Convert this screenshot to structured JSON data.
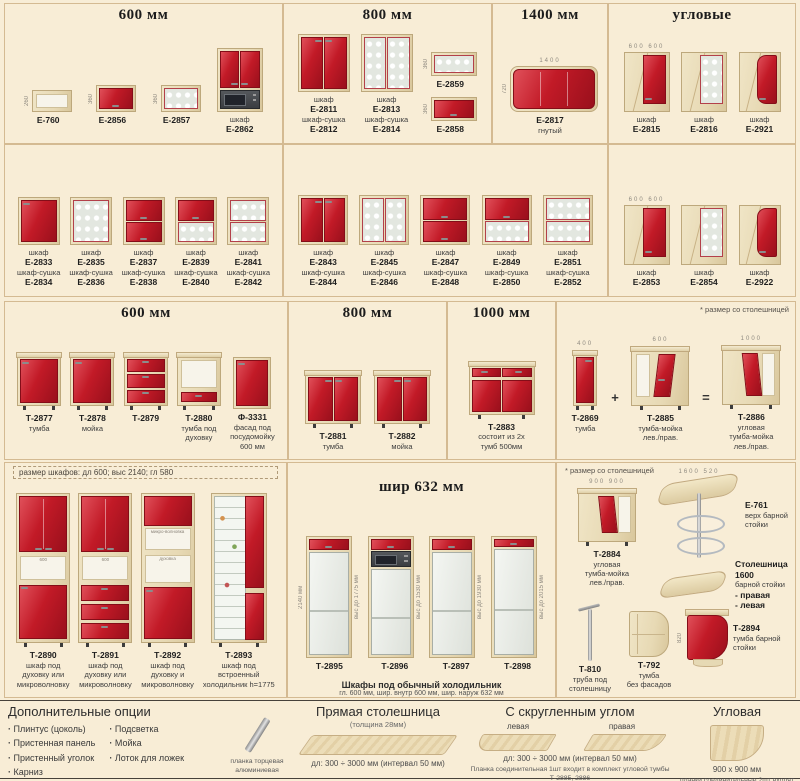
{
  "page": {
    "bg": "#f8edd6",
    "accent_red": "#c21a27",
    "wood": "#e7d9b4"
  },
  "sections": {
    "wall600": {
      "title": "600 мм",
      "items": [
        {
          "style": "openbox",
          "w": 40,
          "h": 22,
          "vl": "260",
          "label": [
            "Е-760"
          ]
        },
        {
          "style": "flip-red",
          "w": 40,
          "h": 27,
          "vl": "360",
          "label": [
            "Е-2856"
          ]
        },
        {
          "style": "flip-glass",
          "w": 40,
          "h": 27,
          "vl": "360",
          "label": [
            "Е-2857"
          ]
        },
        {
          "style": "wall-micro",
          "w": 46,
          "h": 64,
          "label": [
            "шкаф",
            "Е-2862"
          ]
        }
      ]
    },
    "wall800": {
      "title": "800 мм",
      "items": [
        {
          "style": "doors2-red",
          "w": 52,
          "h": 58,
          "label": [
            "шкаф",
            "Е-2811",
            "шкаф-сушка",
            "Е-2812"
          ]
        },
        {
          "style": "doors2-glass",
          "w": 52,
          "h": 58,
          "label": [
            "шкаф",
            "Е-2813",
            "шкаф-сушка",
            "Е-2814"
          ]
        },
        {
          "style": "flip-glass",
          "w": 46,
          "h": 24,
          "vl": "360",
          "label": [
            "Е-2859"
          ]
        },
        {
          "style": "flip-red",
          "w": 46,
          "h": 24,
          "vl": "360",
          "label": [
            "Е-2858"
          ]
        }
      ]
    },
    "wall1400": {
      "title": "1400 мм",
      "items": [
        {
          "style": "bent",
          "w": 88,
          "h": 46,
          "dims": [
            "1400"
          ],
          "vl": "720",
          "label": [
            "Е-2817",
            "гнутый"
          ]
        }
      ]
    },
    "wallcorner": {
      "title": "угловые",
      "items": [
        {
          "style": "corner-red",
          "w": 46,
          "h": 60,
          "dims": [
            "600",
            "600"
          ],
          "label": [
            "шкаф",
            "Е-2815"
          ]
        },
        {
          "style": "corner-glass",
          "w": 46,
          "h": 60,
          "label": [
            "шкаф",
            "Е-2816"
          ]
        },
        {
          "style": "corner-radius",
          "w": 42,
          "h": 60,
          "label": [
            "шкаф",
            "Е-2921"
          ]
        }
      ]
    },
    "row2a": {
      "items": [
        {
          "style": "door1-red",
          "w": 42,
          "h": 48,
          "label": [
            "шкаф",
            "Е-2833",
            "шкаф-сушка",
            "Е-2834"
          ]
        },
        {
          "style": "door1-glass",
          "w": 42,
          "h": 48,
          "label": [
            "шкаф",
            "Е-2835",
            "шкаф-сушка",
            "Е-2836"
          ]
        },
        {
          "style": "flip2-red",
          "w": 42,
          "h": 48,
          "label": [
            "шкаф",
            "Е-2837",
            "шкаф-сушка",
            "Е-2838"
          ]
        },
        {
          "style": "flip-red-glass",
          "w": 42,
          "h": 48,
          "label": [
            "шкаф",
            "Е-2839",
            "шкаф-сушка",
            "Е-2840"
          ]
        },
        {
          "style": "flip2-glass",
          "w": 42,
          "h": 48,
          "label": [
            "шкаф",
            "Е-2841",
            "шкаф-сушка",
            "Е-2842"
          ]
        }
      ]
    },
    "row2b": {
      "items": [
        {
          "style": "doors2-red",
          "w": 50,
          "h": 50,
          "label": [
            "шкаф",
            "Е-2843",
            "шкаф-сушка",
            "Е-2844"
          ]
        },
        {
          "style": "doors2-glass",
          "w": 50,
          "h": 50,
          "label": [
            "шкаф",
            "Е-2845",
            "шкаф-сушка",
            "Е-2846"
          ]
        },
        {
          "style": "flip2-red",
          "w": 50,
          "h": 50,
          "label": [
            "шкаф",
            "Е-2847",
            "шкаф-сушка",
            "Е-2848"
          ]
        },
        {
          "style": "flip-red-glass",
          "w": 50,
          "h": 50,
          "label": [
            "шкаф",
            "Е-2849",
            "шкаф-сушка",
            "Е-2850"
          ]
        },
        {
          "style": "flip2-glass",
          "w": 50,
          "h": 50,
          "label": [
            "шкаф",
            "Е-2851",
            "шкаф-сушка",
            "Е-2852"
          ]
        }
      ]
    },
    "row2c": {
      "items": [
        {
          "style": "corner-red",
          "w": 46,
          "h": 60,
          "dims": [
            "600",
            "600"
          ],
          "label": [
            "шкаф",
            "Е-2853"
          ]
        },
        {
          "style": "corner-glass",
          "w": 46,
          "h": 60,
          "label": [
            "шкаф",
            "Е-2854"
          ]
        },
        {
          "style": "corner-radius",
          "w": 42,
          "h": 60,
          "label": [
            "шкаф",
            "Е-2922"
          ]
        }
      ]
    },
    "base600": {
      "title": "600 мм",
      "items": [
        {
          "style": "base-door1",
          "w": 44,
          "h": 50,
          "base": true,
          "legs": true,
          "label": [
            "Т-2877",
            "тумба"
          ]
        },
        {
          "style": "base-door1",
          "w": 44,
          "h": 50,
          "base": true,
          "legs": true,
          "label": [
            "Т-2878",
            "мойка"
          ]
        },
        {
          "style": "base-drawers3",
          "w": 44,
          "h": 50,
          "base": true,
          "legs": true,
          "label": [
            "Т-2879"
          ]
        },
        {
          "style": "base-oven",
          "w": 44,
          "h": 50,
          "base": true,
          "legs": true,
          "label": [
            "Т-2880",
            "тумба под",
            "духовку"
          ]
        },
        {
          "style": "base-front",
          "w": 38,
          "h": 52,
          "label": [
            "Ф-3331",
            "фасад под",
            "посудомойку",
            "600 мм"
          ]
        }
      ]
    },
    "base800": {
      "title": "800 мм",
      "items": [
        {
          "style": "base-doors2",
          "w": 56,
          "h": 50,
          "base": true,
          "legs": true,
          "label": [
            "Т-2881",
            "тумба"
          ]
        },
        {
          "style": "base-doors2",
          "w": 56,
          "h": 50,
          "base": true,
          "legs": true,
          "label": [
            "Т-2882",
            "мойка"
          ]
        }
      ]
    },
    "base1000": {
      "title": "1000 мм",
      "items": [
        {
          "style": "base-1000",
          "w": 66,
          "h": 50,
          "base": true,
          "legs": true,
          "label": [
            "Т-2883",
            "состоит из 2х",
            "тумб 500мм"
          ]
        }
      ]
    },
    "basecorner": {
      "note": "* размер со столешницей",
      "items": [
        {
          "style": "base-narrow",
          "w": 24,
          "h": 52,
          "base": true,
          "legs": true,
          "dims": [
            "400"
          ],
          "label": [
            "Т-2869",
            "тумба"
          ]
        },
        {
          "style": "sym",
          "sym": "+"
        },
        {
          "style": "base-corner-straight",
          "w": 58,
          "h": 56,
          "base": true,
          "legs": true,
          "dims": [
            "600"
          ],
          "label": [
            "Т-2885",
            "тумба-мойка",
            "лев./прав."
          ]
        },
        {
          "style": "sym",
          "sym": "="
        },
        {
          "style": "base-corner-L",
          "w": 58,
          "h": 56,
          "base": true,
          "legs": true,
          "dims": [
            "1000"
          ],
          "label": [
            "Т-2886",
            "угловая",
            "тумба-мойка",
            "лев./прав."
          ]
        }
      ]
    },
    "tall": {
      "note": "размер шкафов:  дл 600;  выс 2140;  гл 580",
      "items": [
        {
          "style": "tall-a",
          "w": 54,
          "h": 150,
          "legs": true,
          "niches": [
            "600"
          ],
          "label": [
            "Т-2890",
            "шкаф под",
            "духовку или",
            "микроволновку"
          ]
        },
        {
          "style": "tall-b",
          "w": 54,
          "h": 150,
          "legs": true,
          "niches": [
            "600"
          ],
          "label": [
            "Т-2891",
            "шкаф под",
            "духовку или",
            "микроволновку"
          ]
        },
        {
          "style": "tall-c",
          "w": 54,
          "h": 150,
          "legs": true,
          "niches": [
            "микро-волновка",
            "духовка"
          ],
          "label": [
            "Т-2892",
            "шкаф под",
            "духовку и",
            "микроволновку"
          ]
        },
        {
          "style": "tall-fridge",
          "w": 56,
          "h": 150,
          "legs": true,
          "label": [
            "Т-2893",
            "шкаф под",
            "встроенный",
            "холодильник h=1775"
          ]
        }
      ]
    },
    "fridge": {
      "title": "шир 632 мм",
      "caption1": "Шкафы под обычный холодильник",
      "caption2": "гл. 600 мм,    шир. внутр 600 мм,    шир. наруж 632 мм",
      "items": [
        {
          "style": "fridge",
          "w": 46,
          "h": 122,
          "vl": "2140 мм",
          "vr": "выс до 1775 мм",
          "label": [
            "Т-2895"
          ]
        },
        {
          "style": "fridge-micro",
          "w": 46,
          "h": 122,
          "vr": "выс до 1530 мм",
          "label": [
            "Т-2896"
          ]
        },
        {
          "style": "fridge",
          "w": 46,
          "h": 122,
          "vr": "выс до 1930 мм",
          "label": [
            "Т-2897"
          ]
        },
        {
          "style": "fridge-tall",
          "w": 46,
          "h": 122,
          "vr": "выс до 2015 мм",
          "label": [
            "Т-2898"
          ]
        }
      ]
    },
    "bar": {
      "note": "* размер со столешницей",
      "items": [
        {
          "slot": "a",
          "style": "base-corner-L",
          "w": 58,
          "h": 50,
          "base": true,
          "legs": true,
          "dims": [
            "900",
            "900"
          ],
          "label": [
            "Т-2884",
            "угловая",
            "тумба-мойка",
            "лев./прав."
          ]
        },
        {
          "slot": "b",
          "style": "bartop",
          "horiz": true,
          "dims": [
            "1600",
            "520"
          ],
          "label": [
            "Е-761",
            "верх барной",
            "стойки"
          ]
        },
        {
          "slot": "c",
          "style": "barcounter",
          "horiz": true,
          "label": [
            "Столешница 1600",
            "барной стойки",
            "- правая",
            "- левая"
          ]
        },
        {
          "slot": "d",
          "style": "pole",
          "label": [
            "Т-810",
            "труба под",
            "столешницу"
          ]
        },
        {
          "slot": "e",
          "style": "openshelf",
          "label": [
            "Т-792",
            "тумба",
            "без фасадов"
          ]
        },
        {
          "slot": "f",
          "style": "barcab",
          "horiz": true,
          "vl": "820",
          "label": [
            "Т-2894",
            "тумба барной",
            "стойки"
          ]
        }
      ]
    }
  },
  "bottom": {
    "opts": {
      "title": "Дополнительные опции",
      "col1": [
        "Плинтус (цоколь)",
        "Пристенная панель",
        "Пристенный уголок",
        "Карниз"
      ],
      "col2": [
        "Подсветка",
        "Мойка",
        "Лоток для ложек"
      ]
    },
    "strip": {
      "line1": "планка торцевая",
      "line2": "алюминиевая"
    },
    "straight": {
      "title": "Прямая столешница",
      "sub": "(толщина 28мм)",
      "dims": "дл: 300 ÷ 3000 мм (интервал 50 мм)"
    },
    "round": {
      "title": "С скругленным углом",
      "left": "левая",
      "right": "правая",
      "dims": "дл: 300 ÷ 3000 мм (интервал 50 мм)",
      "note1": "Планка соединительная 1шт",
      "note2": "входит в комплект угловой тумбы Т-2885, 2886"
    },
    "corner": {
      "title": "Угловая",
      "size": "900 х 900 мм",
      "note1": "планки соединительные 2шт",
      "note2": "входят в комплект тумбы Т-2884"
    }
  }
}
